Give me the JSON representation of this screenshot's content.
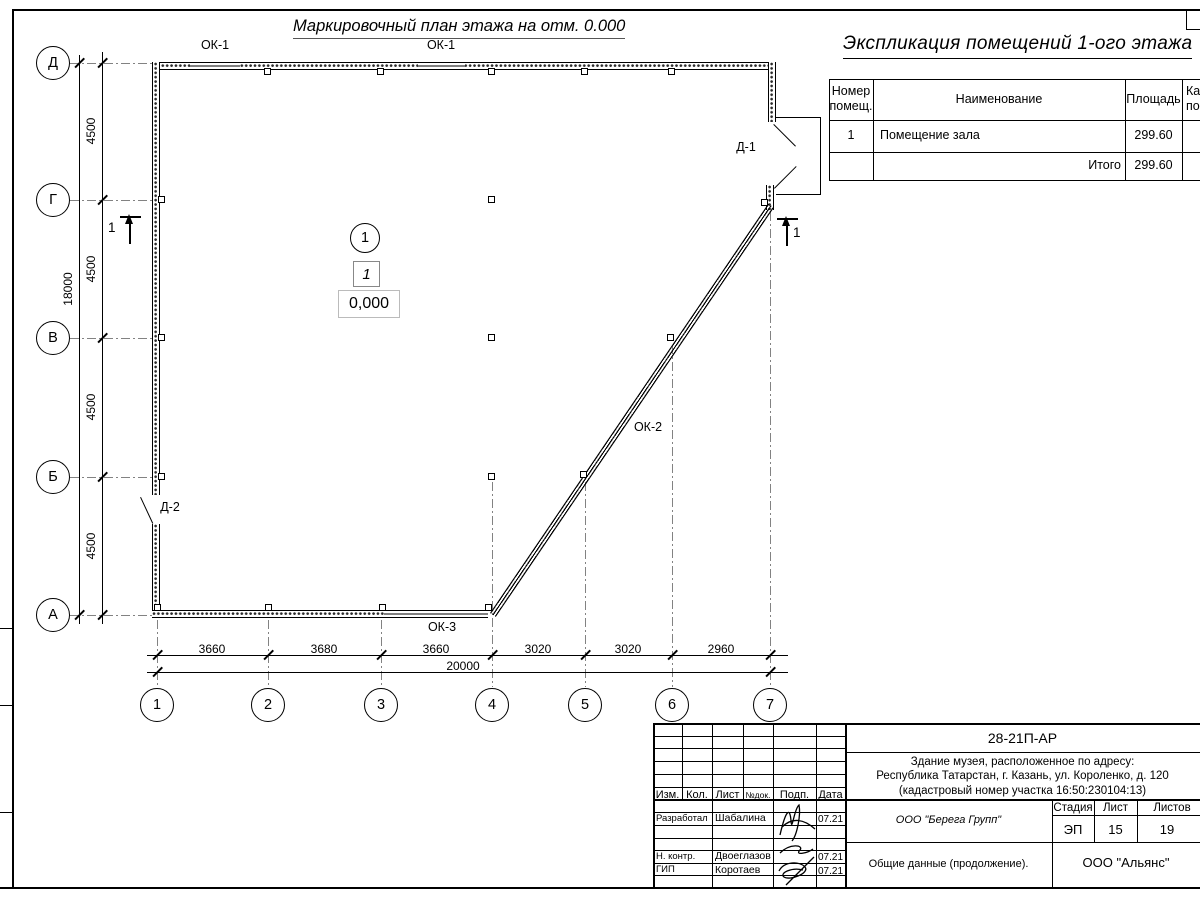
{
  "sheet": {
    "plan_title": "Маркировочный план этажа на отм. 0.000"
  },
  "axes": {
    "rows": [
      "Д",
      "Г",
      "В",
      "Б",
      "А"
    ],
    "cols": [
      "1",
      "2",
      "3",
      "4",
      "5",
      "6",
      "7"
    ]
  },
  "dims": {
    "left": {
      "segments": [
        "4500",
        "4500",
        "4500",
        "4500"
      ],
      "total": "18000"
    },
    "bottom": {
      "segments": [
        "3660",
        "3680",
        "3660",
        "3020",
        "3020",
        "2960"
      ],
      "total": "20000"
    }
  },
  "labels": {
    "ok1_a": "ОК-1",
    "ok1_b": "ОК-1",
    "ok2": "ОК-2",
    "ok3": "ОК-3",
    "d1": "Д-1",
    "d2": "Д-2",
    "section_left": "1",
    "section_right": "1"
  },
  "room": {
    "number": "1",
    "tag": "1",
    "elevation": "0,000"
  },
  "explication": {
    "title": "Экспликация помещений 1-ого этажа",
    "headers": {
      "col1_line1": "Номер",
      "col1_line2": "помещ.",
      "col2": "Наименование",
      "col3": "Площадь",
      "col4_line1": "Ка",
      "col4_line2": "по"
    },
    "rows": [
      {
        "number": "1",
        "name": "Помещение зала",
        "area": "299.60"
      }
    ],
    "total_label": "Итого",
    "total_area": "299.60"
  },
  "titleblock": {
    "code": "28-21П-АР",
    "address_line1": "Здание музея, расположенное по адресу:",
    "address_line2": "Республика Татарстан, г. Казань, ул. Короленко, д. 120",
    "address_line3": "(кадастровый номер участка 16:50:230104:13)",
    "cols": {
      "izm": "Изм.",
      "kol": "Кол.",
      "list": "Лист",
      "ndok": "№док.",
      "podp": "Подп.",
      "data": "Дата"
    },
    "roles": [
      {
        "role": "Разработал",
        "name": "Шабалина",
        "date": "07.21"
      },
      {
        "role": "Н. контр.",
        "name": "Двоеглазов",
        "date": "07.21"
      },
      {
        "role": "ГИП",
        "name": "Коротаев",
        "date": "07.21"
      }
    ],
    "org1": "ООО \"Берега Групп\"",
    "stage_label": "Стадия",
    "sheet_label": "Лист",
    "sheets_label": "Листов",
    "stage": "ЭП",
    "sheet_num": "15",
    "sheets_total": "19",
    "doc_title": "Общие данные (продолжение).",
    "org2": "ООО \"Альянс\""
  }
}
